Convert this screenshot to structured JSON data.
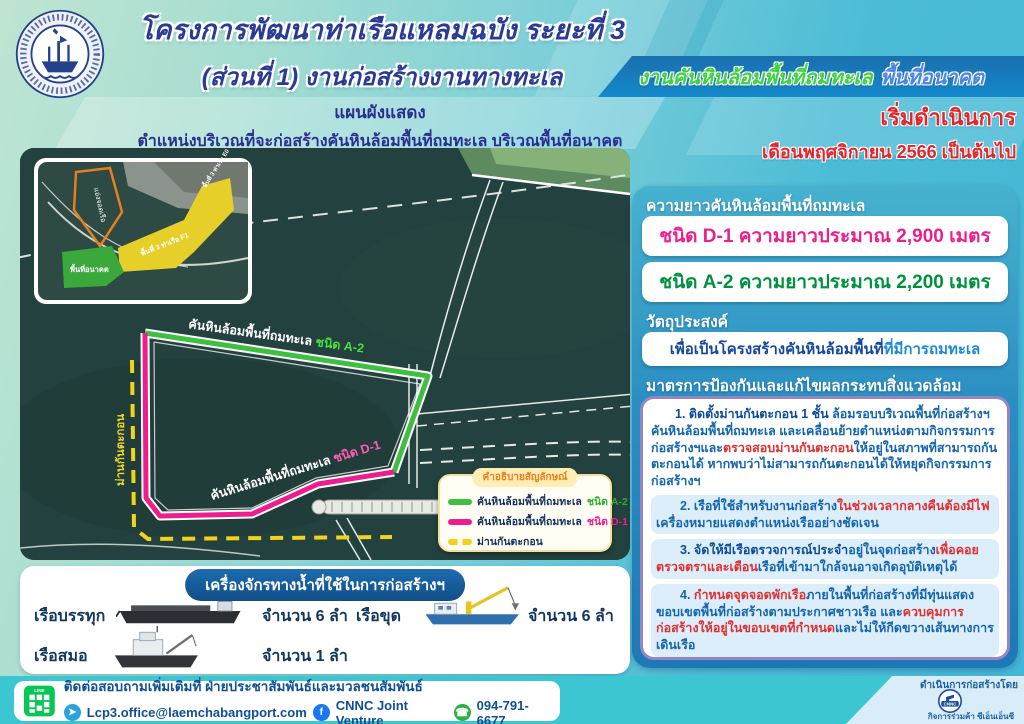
{
  "header": {
    "logo": {
      "name": "การท่าเรือแห่งประเทศไทย",
      "name_en": "PORT AUTHORITY OF THAILAND"
    },
    "title_line1": "โครงการพัฒนาท่าเรือแหลมฉบัง ระยะที่ 3",
    "title_line2": "(ส่วนที่ 1) งานก่อสร้างงานทางทะเล",
    "banner": {
      "part_green": "งานคันหินล้อมพื้นที่ถมทะเล",
      "part_blue": "พื้นที่อนาคต"
    }
  },
  "plan_caption": {
    "line1": "แผนผังแสดง",
    "line2": "ตำแหน่งบริเวณที่จะก่อสร้างคันหินล้อมพื้นที่ถมทะเล บริเวณพื้นที่อนาคต"
  },
  "start_notice": {
    "line1": "เริ่มดำเนินการ",
    "line2": "เดือนพฤศจิกายน 2566 เป็นต้นไป"
  },
  "map": {
    "labels": {
      "a2_prefix": "คันหินล้อมพื้นที่ถมทะเล ",
      "a2_type": "ชนิด A-2",
      "d1_prefix": "คันหินล้อมพื้นที่ถมทะเล ",
      "d1_type": "ชนิด D-1",
      "silt_curtain": "ม่านกันตะกอน"
    },
    "inset": {
      "basin": "แอ่งจอดเรือ",
      "future_area": "พื้นที่อนาคต",
      "area_f1": "พื้นที่ 3 ท่าเรือ F1",
      "area_e0": "พื้นที่ 3 ท่าเรือ E0"
    },
    "legend": {
      "title": "คำอธิบายสัญลักษณ์",
      "items": [
        {
          "label": "คันหินล้อมพื้นที่ถมทะเล",
          "type": "ชนิด A-2",
          "color": "#3fbf3f"
        },
        {
          "label": "คันหินล้อมพื้นที่ถมทะเล",
          "type": "ชนิด D-1",
          "color": "#ee1d8e"
        },
        {
          "label": "ม่านกันตะกอน",
          "type": "",
          "color": "#f2d31b"
        }
      ]
    }
  },
  "lengths": {
    "title": "ความยาวคันหินล้อมพื้นที่ถมทะเล",
    "d1": {
      "text": "ชนิด D-1  ความยาวประมาณ  2,900 เมตร",
      "color": "#ec1f8e"
    },
    "a2": {
      "text": "ชนิด A-2  ความยาวประมาณ  2,200 เมตร",
      "color": "#00913f"
    }
  },
  "objective": {
    "title": "วัตถุประสงค์",
    "seg_dark": "เพื่อเป็นโครงสร้างคันหินล้อมพื้นที่",
    "seg_light": "ที่มีการถมทะเล"
  },
  "measures": {
    "title": "มาตรการป้องกันและแก้ไขผลกระทบสิ่งแวดล้อม",
    "items": [
      {
        "segments": [
          {
            "t": "1. ติดตั้งม่านกันตะกอน 1 ชั้น ",
            "c": "strong"
          },
          {
            "t": "ล้อมรอบบริเวณพื้นที่ก่อสร้างฯ คันหินล้อมพื้นที่ถมทะเล และเคลื่อนย้ายตำแหน่งตามกิจกรรมการก่อสร้างฯและ",
            "c": "norm"
          },
          {
            "t": "ตรวจสอบม่านกันตะกอน",
            "c": "red"
          },
          {
            "t": "ให้อยู่ในสภาพที่สามารถกันตะกอนได้ หากพบว่าไม่สามารถกันตะกอนได้ให้หยุดกิจกรรมการก่อสร้างฯ",
            "c": "norm"
          }
        ]
      },
      {
        "segments": [
          {
            "t": "2. เรือที่ใช้สำหรับงานก่อสร้าง",
            "c": "norm"
          },
          {
            "t": "ในช่วงเวลากลางคืนต้องมีไฟ",
            "c": "red"
          },
          {
            "t": "เครื่องหมายแสดงตำแหน่งเรืออย่างชัดเจน",
            "c": "norm"
          }
        ]
      },
      {
        "segments": [
          {
            "t": "3. จัดให้มีเรือตรวจการณ์ประจำ",
            "c": "strong"
          },
          {
            "t": "อยู่ในจุดก่อสร้าง",
            "c": "norm"
          },
          {
            "t": "เพื่อคอยตรวจตราและเตือน",
            "c": "red"
          },
          {
            "t": "เรือที่เข้ามาใกล้จนอาจเกิดอุบัติเหตุได้",
            "c": "norm"
          }
        ]
      },
      {
        "segments": [
          {
            "t": "4. ",
            "c": "norm"
          },
          {
            "t": "กำหนดจุดจอดพักเรือ",
            "c": "red"
          },
          {
            "t": "ภายในพื้นที่ก่อสร้างที่มีทุ่นแสดงขอบเขตพื้นที่ก่อสร้างตามประกาศชาวเรือ และ",
            "c": "norm"
          },
          {
            "t": "ควบคุมการก่อสร้างให้อยู่ในขอบเขตที่กำหนด",
            "c": "red"
          },
          {
            "t": "และไม่ให้กีดขวางเส้นทางการเดินเรือ",
            "c": "norm"
          }
        ]
      }
    ]
  },
  "machinery": {
    "title": "เครื่องจักรทางน้ำที่ใช้ในการก่อสร้างฯ",
    "rows": [
      {
        "label": "เรือบรรทุก",
        "count": "จำนวน 6 ลำ"
      },
      {
        "label": "เรือขุด",
        "count": "จำนวน 6 ลำ"
      },
      {
        "label": "เรือสมอ",
        "count": "จำนวน 1 ลำ"
      }
    ]
  },
  "footer": {
    "contact_heading": "ติดต่อสอบถามเพิ่มเติมที่ ฝ่ายประชาสัมพันธ์และมวลชนสัมพันธ์",
    "email": "Lcp3.office@laemchabangport.com",
    "facebook": "CNNC Joint Venture",
    "phone": "094-791-6677",
    "line_label": "LINE",
    "builder": {
      "label": "ดำเนินการก่อสร้างโดย",
      "logo_text": "CNNC",
      "name": "กิจการร่วมค้า ซีเอ็นเอ็นซี"
    }
  },
  "colors": {
    "accent_pink": "#ec1f8e",
    "accent_green": "#00913f",
    "line_green": "#3fbf3f",
    "curtain_yellow": "#f2d31b",
    "alert_red": "#e03030",
    "primary_blue": "#1565ae",
    "panel_blue": "#2b8ec2"
  }
}
